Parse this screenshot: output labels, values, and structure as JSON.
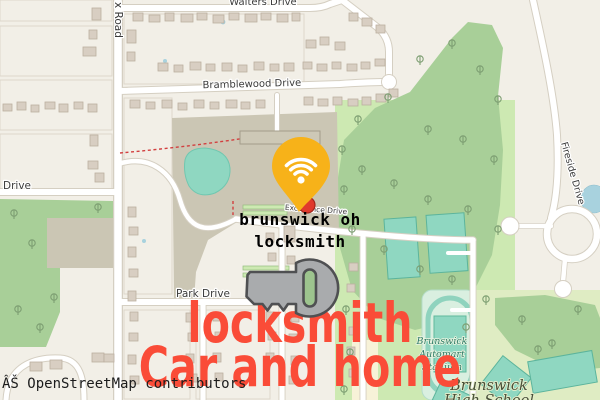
{
  "map": {
    "streets": {
      "walters_drive": "Walters Drive",
      "x_road": "x Road",
      "bramblewood_drive": "Bramblewood Drive",
      "west_drive": "Drive",
      "park_drive": "Park Drive",
      "excellence_drive": "Excellence Drive",
      "fireside_drive": "Fireside Drive"
    },
    "places": {
      "automart_lines": [
        "Brunswick",
        "Automart",
        "Stadium"
      ],
      "school_lines": [
        "Brunswick",
        "High School"
      ]
    },
    "attribution": "ÂŠ OpenStreetMap contributors"
  },
  "overlay": {
    "search_query": {
      "line1": "brunswick oh",
      "line2": "locksmith"
    },
    "headline": {
      "line1": "locksmith",
      "line2": "Car and home"
    },
    "pin_icon": "wifi-pin",
    "key_icon": "key"
  },
  "colors": {
    "accent_red": "#fa4c38",
    "pin_yellow": "#f7b219",
    "marker_red": "#e03a2d",
    "key_gray": "#a9abad",
    "key_outline": "#4f5052",
    "forest_green": "#a8cf98",
    "pitch_teal": "#8fd7c1",
    "water_blue": "#a8d2de",
    "campus_tan": "#cbc6b4"
  }
}
